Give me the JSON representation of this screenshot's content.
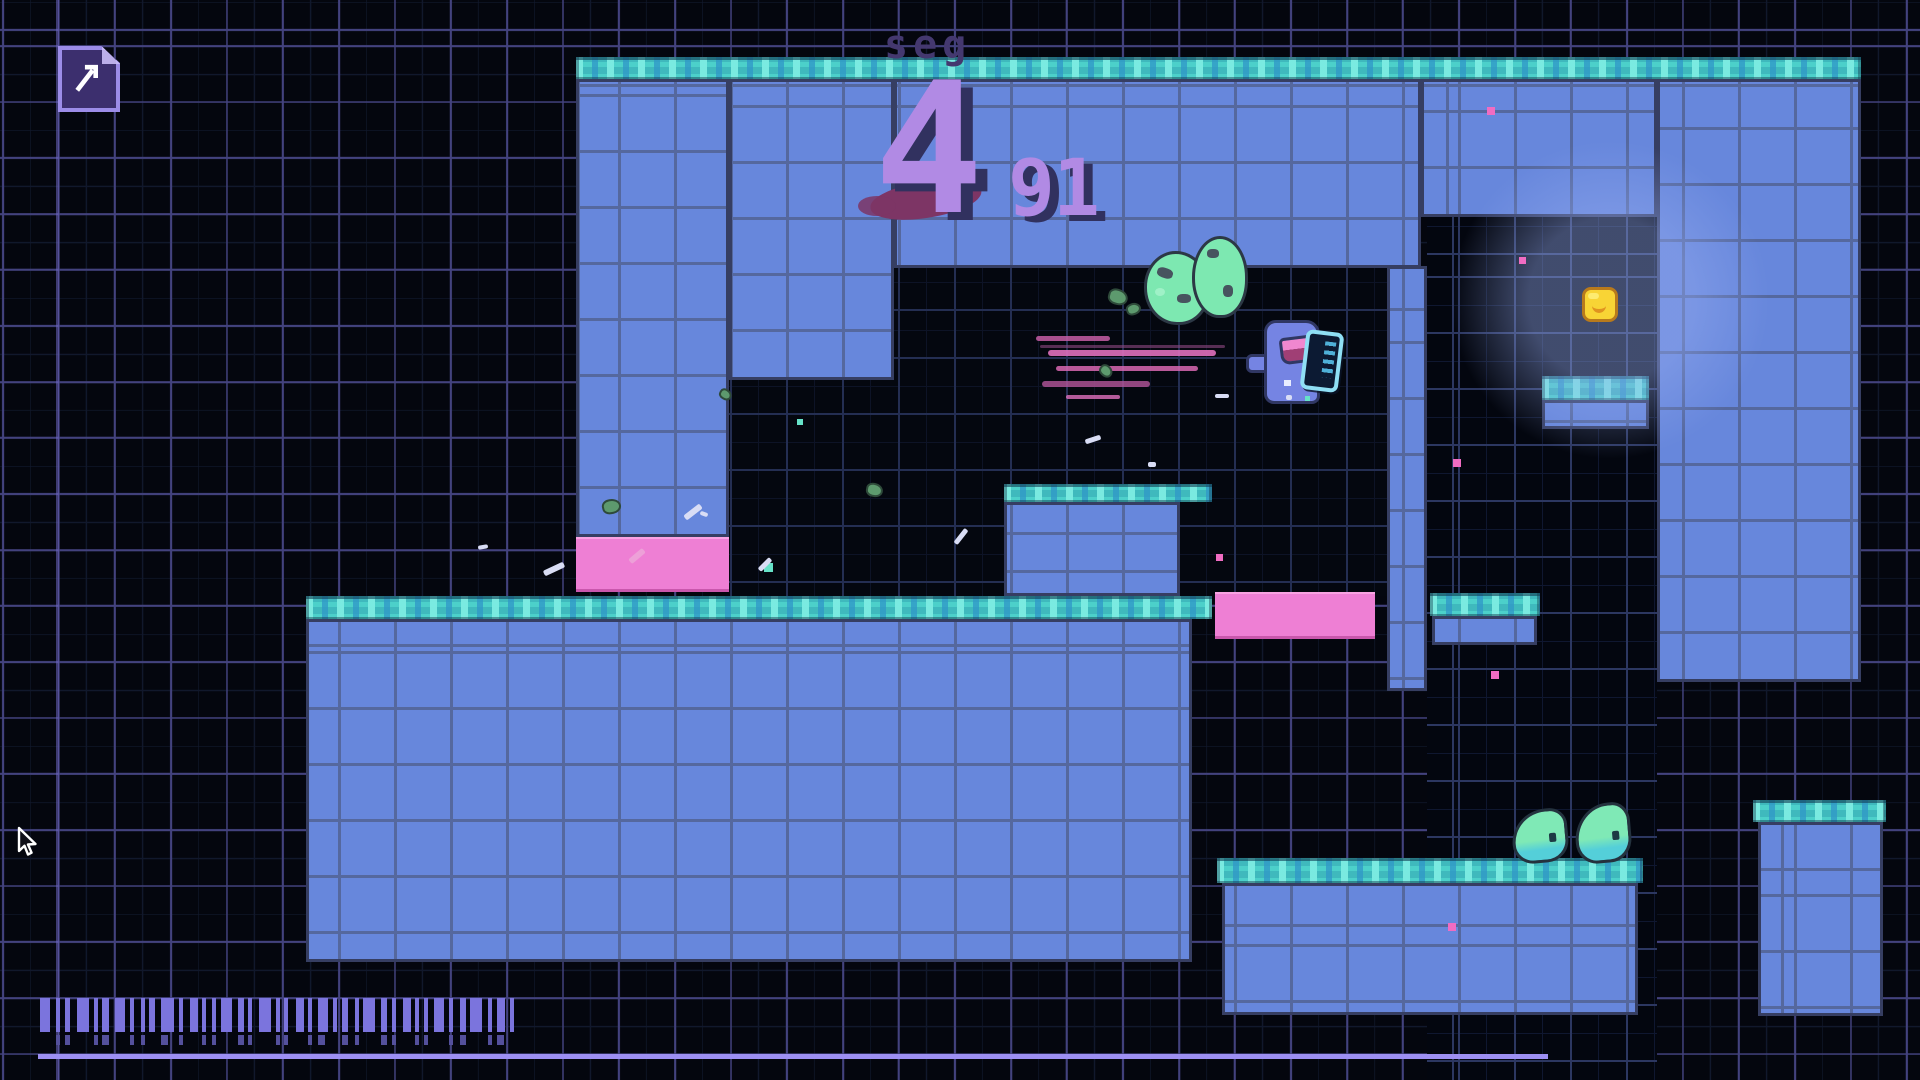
{
  "hud": {
    "segment_label": "seg",
    "segment_number": "4",
    "segment_subcount": "91"
  },
  "palette": {
    "background": "#04060e",
    "grid_purple": "#43427e",
    "platform_blue": "#6787dc",
    "platform_grout": "#55689e",
    "teal_top": "#3fb9bd",
    "teal_light": "#7decE2",
    "hazard_pink": "#ee7fd4",
    "hud_lavender": "#b18ae4",
    "hud_shadow": "#31315f",
    "slime_green": "#7de8b1",
    "slime_cyan": "#54cfd9",
    "coin_yellow": "#f8d435",
    "player_periwinkle": "#7584e3",
    "door_cyan": "#8fdff5",
    "barcode_purple": "#7b74dd"
  },
  "entities": {
    "player": {
      "x": 1248,
      "y": 318
    },
    "door": {
      "x": 1303,
      "y": 331
    },
    "cave_slime_1": {
      "x": 1144,
      "y": 251
    },
    "cave_slime_2": {
      "x": 1192,
      "y": 236
    },
    "floor_slime_1": {
      "x": 1512,
      "y": 809
    },
    "floor_slime_2": {
      "x": 1575,
      "y": 803
    },
    "coin": {
      "x": 1582,
      "y": 287
    },
    "cursor": {
      "x": 16,
      "y": 826
    },
    "map_icon": {
      "x": 58,
      "y": 46
    }
  },
  "speed_lines": [
    {
      "x": 1036,
      "y": 336,
      "w": 74,
      "h": 5,
      "c": "#c55da4",
      "o": 0.85
    },
    {
      "x": 1040,
      "y": 345,
      "w": 185,
      "h": 3,
      "c": "#8f4a82",
      "o": 0.6
    },
    {
      "x": 1048,
      "y": 350,
      "w": 168,
      "h": 6,
      "c": "#e070bd",
      "o": 0.9
    },
    {
      "x": 1056,
      "y": 366,
      "w": 142,
      "h": 5,
      "c": "#d967b2",
      "o": 0.85
    },
    {
      "x": 1042,
      "y": 381,
      "w": 108,
      "h": 6,
      "c": "#b5569b",
      "o": 0.8
    },
    {
      "x": 1066,
      "y": 395,
      "w": 54,
      "h": 4,
      "c": "#e070bd",
      "o": 0.8
    }
  ],
  "particles": {
    "pink_squares": [
      {
        "x": 1487,
        "y": 107,
        "s": 8
      },
      {
        "x": 1519,
        "y": 257,
        "s": 7
      },
      {
        "x": 1453,
        "y": 459,
        "s": 8
      },
      {
        "x": 1216,
        "y": 554,
        "s": 7
      },
      {
        "x": 1491,
        "y": 671,
        "s": 8
      },
      {
        "x": 1448,
        "y": 923,
        "s": 8
      }
    ],
    "teal_squares": [
      {
        "x": 764,
        "y": 563,
        "s": 9
      },
      {
        "x": 797,
        "y": 419,
        "s": 6
      },
      {
        "x": 1305,
        "y": 396,
        "s": 5
      }
    ],
    "green_splats": [
      {
        "x": 1108,
        "y": 289,
        "s": 16,
        "r": 15
      },
      {
        "x": 1126,
        "y": 303,
        "s": 11,
        "r": -20
      },
      {
        "x": 1099,
        "y": 365,
        "s": 10,
        "r": 40
      },
      {
        "x": 866,
        "y": 483,
        "s": 13,
        "r": 10
      },
      {
        "x": 602,
        "y": 499,
        "s": 15,
        "r": -12
      },
      {
        "x": 719,
        "y": 389,
        "s": 9,
        "r": 30
      }
    ],
    "debris": [
      {
        "x": 683,
        "y": 509,
        "w": 20,
        "h": 6,
        "r": -38
      },
      {
        "x": 543,
        "y": 566,
        "w": 22,
        "h": 6,
        "r": -25
      },
      {
        "x": 757,
        "y": 562,
        "w": 16,
        "h": 5,
        "r": -45
      },
      {
        "x": 952,
        "y": 534,
        "w": 18,
        "h": 5,
        "r": -52
      },
      {
        "x": 1085,
        "y": 437,
        "w": 16,
        "h": 5,
        "r": -18
      },
      {
        "x": 1148,
        "y": 462,
        "w": 8,
        "h": 5,
        "r": 0
      },
      {
        "x": 478,
        "y": 545,
        "w": 10,
        "h": 4,
        "r": -10
      },
      {
        "x": 1215,
        "y": 394,
        "w": 14,
        "h": 4,
        "r": 0
      },
      {
        "x": 628,
        "y": 553,
        "w": 18,
        "h": 6,
        "r": -40,
        "c": "#eda0d8"
      },
      {
        "x": 700,
        "y": 512,
        "w": 8,
        "h": 4,
        "r": 20
      },
      {
        "x": 1286,
        "y": 395,
        "w": 6,
        "h": 5,
        "r": 0
      }
    ]
  },
  "barcode": {
    "x": 40,
    "y": 998,
    "h": 34,
    "y2": 1035,
    "h2": 10,
    "bars": [
      {
        "w": 10,
        "g": 6
      },
      {
        "w": 4,
        "g": 5
      },
      {
        "w": 5,
        "g": 7
      },
      {
        "w": 12,
        "g": 5
      },
      {
        "w": 4,
        "g": 4
      },
      {
        "w": 7,
        "g": 6
      },
      {
        "w": 10,
        "g": 5
      },
      {
        "w": 4,
        "g": 7
      },
      {
        "w": 4,
        "g": 4
      },
      {
        "w": 6,
        "g": 6
      },
      {
        "w": 13,
        "g": 5
      },
      {
        "w": 4,
        "g": 7
      },
      {
        "w": 8,
        "g": 4
      },
      {
        "w": 4,
        "g": 6
      },
      {
        "w": 4,
        "g": 5
      },
      {
        "w": 11,
        "g": 6
      },
      {
        "w": 6,
        "g": 4
      },
      {
        "w": 4,
        "g": 7
      },
      {
        "w": 12,
        "g": 5
      },
      {
        "w": 4,
        "g": 4
      },
      {
        "w": 4,
        "g": 8
      },
      {
        "w": 8,
        "g": 4
      },
      {
        "w": 4,
        "g": 6
      },
      {
        "w": 10,
        "g": 5
      },
      {
        "w": 4,
        "g": 5
      },
      {
        "w": 6,
        "g": 7
      },
      {
        "w": 4,
        "g": 4
      },
      {
        "w": 12,
        "g": 6
      },
      {
        "w": 6,
        "g": 5
      },
      {
        "w": 4,
        "g": 7
      },
      {
        "w": 8,
        "g": 4
      },
      {
        "w": 4,
        "g": 5
      },
      {
        "w": 4,
        "g": 6
      },
      {
        "w": 10,
        "g": 5
      },
      {
        "w": 4,
        "g": 7
      },
      {
        "w": 6,
        "g": 4
      },
      {
        "w": 12,
        "g": 6
      },
      {
        "w": 4,
        "g": 5
      },
      {
        "w": 8,
        "g": 5
      },
      {
        "w": 4,
        "g": 6
      }
    ]
  }
}
